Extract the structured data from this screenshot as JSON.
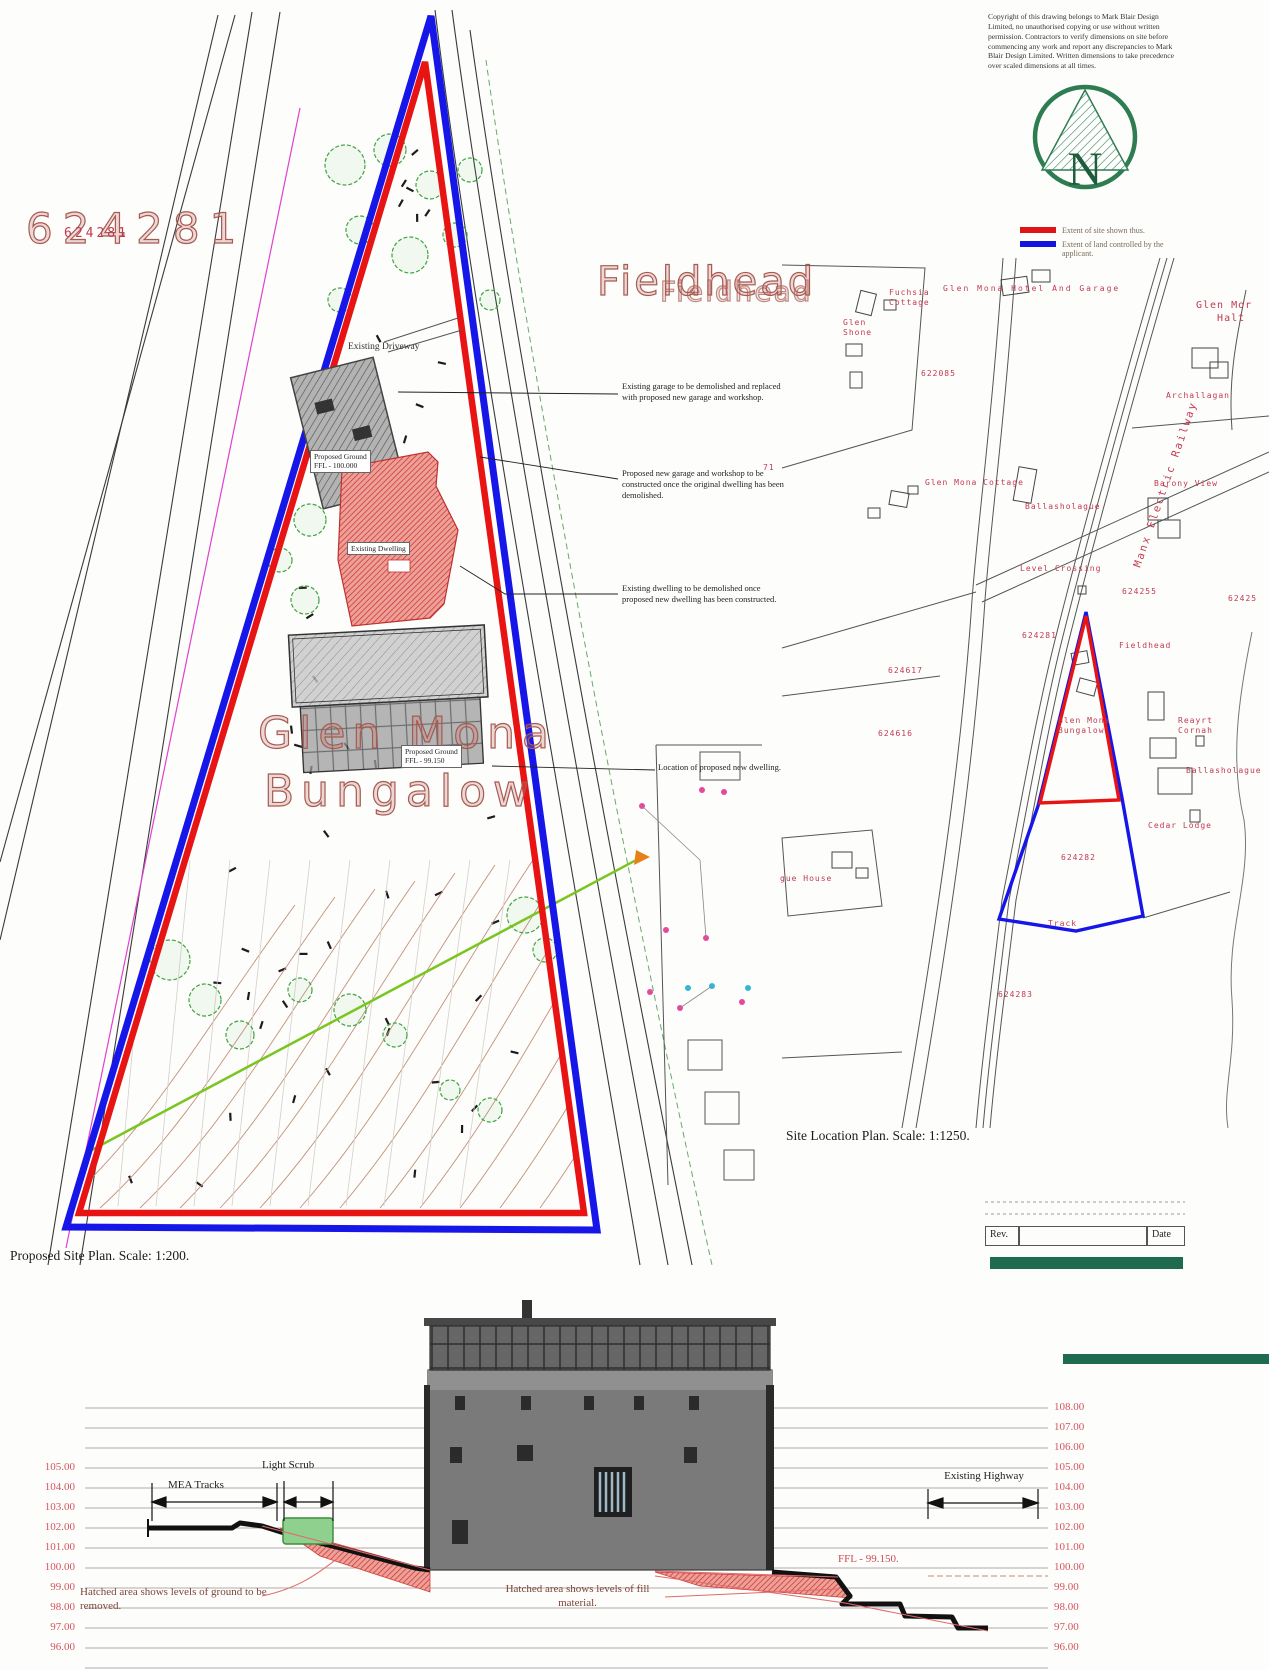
{
  "copyright": "Copyright of this drawing belongs to Mark Blair Design Limited, no unauthorised copying or use without written permission. Contractors to verify dimensions on site before commencing any work and report any discrepancies to Mark Blair Design Limited. Written dimensions to take precedence over scaled dimensions at all times.",
  "north": {
    "letter": "N"
  },
  "legend": {
    "site": {
      "label": "Extent of site shown thus.",
      "color": "#e01414"
    },
    "control": {
      "label": "Extent of land controlled by the applicant.",
      "color": "#1414e0"
    }
  },
  "site_plan": {
    "caption": "Proposed Site Plan. Scale: 1:200.",
    "big_parcel_number": "624281",
    "big_parcel_number_overlay": "624281",
    "fieldhead_big": "Fieldhead",
    "glen_mona_line1": "Glen Mona",
    "glen_mona_line2": "Bungalow",
    "labels": {
      "existing_driveway": "Existing Driveway",
      "garage_ffl": "Proposed Ground\nFFL - 100.000",
      "existing_dwelling": "Existing Dwelling",
      "new_dwelling_ffl": "Proposed Ground\nFFL - 99.150"
    },
    "annotations": [
      "Existing garage to be demolished and replaced with proposed new garage and workshop.",
      "Proposed new garage and workshop to be constructed once the original dwelling has been demolished.",
      "Existing dwelling to be demolished once proposed new dwelling has been constructed.",
      "Location of proposed new dwelling."
    ]
  },
  "location_plan": {
    "caption": "Site Location Plan. Scale: 1:1250.",
    "labels": {
      "fuchsia_cottage": "Fuchsia\nCottage",
      "glen_mona_hotel": "Glen Mona Hotel And Garage",
      "glen_shone": "Glen\nShone",
      "glen_mona_halt": "Glen Mor\n   Halt",
      "archallagan": "Archallagan",
      "glen_mona_cottage": "Glen Mona Cottage",
      "ballasholague_left": "Ballasholague",
      "barony_view": "Barony View",
      "manx_electric_railway": "Manx Electric Railway",
      "level_crossing": "Level Crossing",
      "fieldhead": "Fieldhead",
      "glen_mona_bungalow": "Glen Mona\nBungalow",
      "reayrt_cornah": "Reayrt\nCornah",
      "ballasholague_right": "Ballasholague",
      "cedar_lodge": "Cedar Lodge",
      "track": "Track",
      "gue_house": "gue House"
    },
    "parcel_numbers": {
      "n622085": "622085",
      "n624255": "624255",
      "n62425": "62425",
      "n624281": "624281",
      "n624617": "624617",
      "n624616": "624616",
      "n624282": "624282",
      "n624283": "624283",
      "n71": "71"
    }
  },
  "revision_table": {
    "rev": "Rev.",
    "date": "Date"
  },
  "section": {
    "left_levels": [
      "105.00",
      "104.00",
      "103.00",
      "102.00",
      "101.00",
      "100.00",
      "99.00",
      "98.00",
      "97.00",
      "96.00"
    ],
    "right_levels": [
      "108.00",
      "107.00",
      "106.00",
      "105.00",
      "104.00",
      "103.00",
      "102.00",
      "101.00",
      "100.00",
      "99.00",
      "98.00",
      "97.00",
      "96.00"
    ],
    "mea_tracks": "MEA Tracks",
    "light_scrub": "Light Scrub",
    "existing_highway": "Existing Highway",
    "ffl": "FFL - 99.150.",
    "removed_note": "Hatched area shows levels of ground to be removed.",
    "fill_note": "Hatched area shows levels of fill material."
  }
}
